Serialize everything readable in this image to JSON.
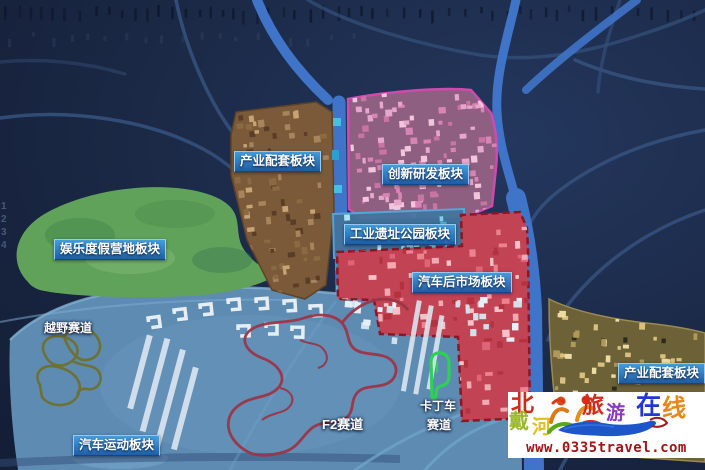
{
  "map": {
    "zone_labels": [
      {
        "id": "industry-support-nw",
        "label": "产业配套板块"
      },
      {
        "id": "innovation-rd",
        "label": "创新研发板块"
      },
      {
        "id": "leisure-resort-camp",
        "label": "娱乐度假营地板块"
      },
      {
        "id": "industrial-heritage-park",
        "label": "工业遗址公园板块"
      },
      {
        "id": "auto-aftermarket",
        "label": "汽车后市场板块"
      },
      {
        "id": "industry-support-se",
        "label": "产业配套板块"
      },
      {
        "id": "auto-sports",
        "label": "汽车运动板块"
      }
    ],
    "track_labels": [
      {
        "id": "offroad-track",
        "label": "越野赛道"
      },
      {
        "id": "f2-track",
        "label": "F2赛道"
      },
      {
        "id": "karting-track",
        "line1": "卡丁车",
        "line2": "赛道"
      }
    ],
    "side_marks": "1\n2\n3\n4",
    "colors": {
      "background": "#1a2742",
      "road": "#35517c",
      "river": "#3f74c8",
      "zone_industry_nw": "#7b5a39",
      "zone_innovation": "#8e5f80",
      "zone_leisure": "#61a25a",
      "zone_heritage": "#44759e",
      "zone_aftermarket": "#c24353",
      "zone_industry_se": "#6d6138",
      "zone_auto_sports": "#5d8bb2",
      "track_offroad": "#6f702e",
      "track_f2": "#9c3548",
      "track_karting": "#2ed155",
      "label_box": "#2a7ec4"
    }
  },
  "watermark": {
    "site_name_chars": [
      {
        "char": "北",
        "color": "#d42a1a"
      },
      {
        "char": "戴",
        "color": "#9ab82a"
      },
      {
        "char": "河",
        "color": "#e0c020"
      },
      {
        "char": "旅",
        "color": "#d42a1a"
      },
      {
        "char": "游",
        "color": "#8a3ac0"
      },
      {
        "char": "在",
        "color": "#2038d0"
      },
      {
        "char": "线",
        "color": "#e8861a"
      }
    ],
    "url": "www.0335travel.com"
  }
}
